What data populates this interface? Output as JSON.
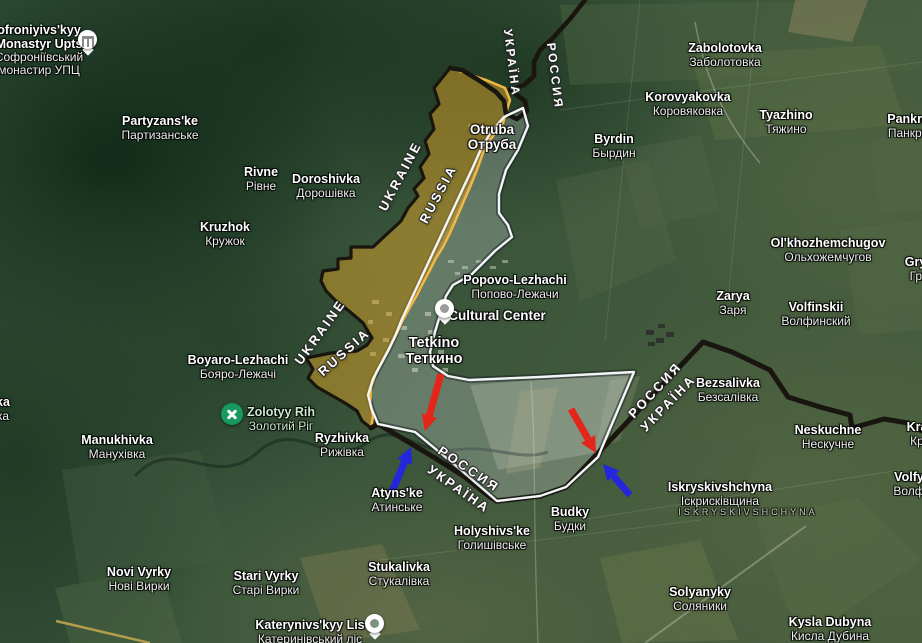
{
  "map_title": "Tetkino border area — annotated control map",
  "colors": {
    "zone_orange_fill": "rgba(222,163,40,0.5)",
    "zone_orange_stroke": "#f2b844",
    "zone_white_fill": "rgba(233,238,240,0.25)",
    "zone_white_stroke": "#f3f6f7",
    "state_border": "#19150f",
    "arrow_red": "#e3251a",
    "arrow_blue": "#2426dd",
    "park_label": "#cbe8cf"
  },
  "places": [
    {
      "lines": [
        "ofroniyivs'kyy",
        "Monastyr Upts",
        "Софроніївський",
        "монастир УПЦ"
      ],
      "x": 39,
      "y": 24,
      "nb": 2
    },
    {
      "lines": [
        "Partyzans'ke",
        "Партизанське"
      ],
      "x": 160,
      "y": 115
    },
    {
      "lines": [
        "Rivne",
        "Рівне"
      ],
      "x": 261,
      "y": 166
    },
    {
      "lines": [
        "Doroshivka",
        "Дорошівка"
      ],
      "x": 326,
      "y": 173
    },
    {
      "lines": [
        "Kruzhok",
        "Кружок"
      ],
      "x": 225,
      "y": 221
    },
    {
      "lines": [
        "Otruba",
        "Отруба"
      ],
      "x": 492,
      "y": 123,
      "nb": 2,
      "size": 13.5
    },
    {
      "lines": [
        "Zabolotovka",
        "Заболотовка"
      ],
      "x": 725,
      "y": 42
    },
    {
      "lines": [
        "Korovyakovka",
        "Коровяковка"
      ],
      "x": 688,
      "y": 91
    },
    {
      "lines": [
        "Tyazhino",
        "Тяжино"
      ],
      "x": 786,
      "y": 109
    },
    {
      "lines": [
        "Pankrato",
        "Панкрато"
      ],
      "x": 914,
      "y": 113
    },
    {
      "lines": [
        "Byrdin",
        "Бырдин"
      ],
      "x": 614,
      "y": 133
    },
    {
      "lines": [
        "Ol'khozhemchugov",
        "Ольхожемчугов"
      ],
      "x": 828,
      "y": 237
    },
    {
      "lines": [
        "Grya",
        "Гря"
      ],
      "x": 919,
      "y": 256
    },
    {
      "lines": [
        "Zarya",
        "Заря"
      ],
      "x": 733,
      "y": 290
    },
    {
      "lines": [
        "Volfinskii",
        "Волфинский"
      ],
      "x": 816,
      "y": 301
    },
    {
      "lines": [
        "Popovo-Lezhachi",
        "Попово-Лежачи"
      ],
      "x": 515,
      "y": 274
    },
    {
      "lines": [
        "Cultural Center"
      ],
      "x": 497,
      "y": 309,
      "size": 13.5
    },
    {
      "lines": [
        "Tetkino",
        "Теткино"
      ],
      "x": 434,
      "y": 336,
      "nb": 2,
      "size": 14.5
    },
    {
      "lines": [
        "Boyaro-Lezhachi",
        "Бояро-Лежачі"
      ],
      "x": 238,
      "y": 354
    },
    {
      "lines": [
        "Zolotyy Rih",
        "Золотий Ріг"
      ],
      "x": 281,
      "y": 406,
      "color": "#cbe8cf"
    },
    {
      "lines": [
        "Manukhivka",
        "Манухівка"
      ],
      "x": 117,
      "y": 434
    },
    {
      "lines": [
        "Ryzhivka",
        "Рижівка"
      ],
      "x": 342,
      "y": 432
    },
    {
      "lines": [
        "Atyns'ke",
        "Атинське"
      ],
      "x": 397,
      "y": 487
    },
    {
      "lines": [
        "Bezsalivka",
        "Безсалівка"
      ],
      "x": 728,
      "y": 377
    },
    {
      "lines": [
        "Neskuchne",
        "Нескучне"
      ],
      "x": 828,
      "y": 424
    },
    {
      "lines": [
        "Kra",
        "Кр"
      ],
      "x": 917,
      "y": 421
    },
    {
      "lines": [
        "Volfy",
        "Волф"
      ],
      "x": 909,
      "y": 471
    },
    {
      "lines": [
        "Iskryskivshchyna",
        "Іскрисківщина"
      ],
      "x": 720,
      "y": 481
    },
    {
      "lines": [
        "ISKRYSKIVSHCHYNA"
      ],
      "x": 748,
      "y": 508,
      "size": 9.5,
      "color": "rgba(228,231,226,0.85)",
      "spacing": 3,
      "nb": 0
    },
    {
      "lines": [
        "Budky",
        "Будки"
      ],
      "x": 570,
      "y": 506
    },
    {
      "lines": [
        "Holyshivs'ke",
        "Голишівське"
      ],
      "x": 492,
      "y": 525
    },
    {
      "lines": [
        "Stukalivka",
        "Стукалівка"
      ],
      "x": 399,
      "y": 561
    },
    {
      "lines": [
        "Novi Vyrky",
        "Нові Вирки"
      ],
      "x": 139,
      "y": 566
    },
    {
      "lines": [
        "Stari Vyrky",
        "Старі Вирки"
      ],
      "x": 266,
      "y": 570
    },
    {
      "lines": [
        "Katerynivs'kyy Lis",
        "Катеринівський ліс"
      ],
      "x": 310,
      "y": 619
    },
    {
      "lines": [
        "Solyanyky",
        "Соляники"
      ],
      "x": 700,
      "y": 586
    },
    {
      "lines": [
        "Kysla Dubyna",
        "Кисла Дубина"
      ],
      "x": 830,
      "y": 616
    },
    {
      "lines": [
        "ka",
        "ка"
      ],
      "x": 3,
      "y": 396
    }
  ],
  "border_labels": [
    {
      "text": "UKRAINE",
      "x": 400,
      "y": 176,
      "rotate": -62
    },
    {
      "text": "RUSSIA",
      "x": 438,
      "y": 194,
      "rotate": -62
    },
    {
      "text": "UKRAINE",
      "x": 320,
      "y": 332,
      "rotate": -54
    },
    {
      "text": "RUSSIA",
      "x": 344,
      "y": 352,
      "rotate": -42
    },
    {
      "text": "УКРАЇНА",
      "x": 512,
      "y": 63,
      "rotate": 83,
      "size": 12
    },
    {
      "text": "РОССИЯ",
      "x": 555,
      "y": 76,
      "rotate": 83,
      "size": 12
    },
    {
      "text": "РОССИЯ",
      "x": 469,
      "y": 469,
      "rotate": 34
    },
    {
      "text": "УКРАЇНА",
      "x": 459,
      "y": 489,
      "rotate": 35
    },
    {
      "text": "РОССИЯ",
      "x": 655,
      "y": 390,
      "rotate": -47
    },
    {
      "text": "УКРАЇНА",
      "x": 668,
      "y": 403,
      "rotate": -46
    }
  ],
  "pois": [
    {
      "icon": "monastery-icon",
      "style": "white mon-pin",
      "x": 88,
      "y": 42
    },
    {
      "icon": "cultural-center-icon",
      "style": "white",
      "x": 445,
      "y": 311
    },
    {
      "icon": "attraction-icon",
      "style": "green",
      "x": 232,
      "y": 414
    },
    {
      "icon": "park-icon",
      "style": "white park",
      "x": 375,
      "y": 626
    }
  ],
  "arrows": [
    {
      "name": "red-attack-arrow-west",
      "color": "#e3251a",
      "x1": 441,
      "y1": 374,
      "x2": 425,
      "y2": 431
    },
    {
      "name": "red-attack-arrow-east",
      "color": "#e3251a",
      "x1": 571,
      "y1": 409,
      "x2": 596,
      "y2": 453
    },
    {
      "name": "blue-counter-arrow-west",
      "color": "#2426dd",
      "x1": 391,
      "y1": 494,
      "x2": 411,
      "y2": 447
    },
    {
      "name": "blue-counter-arrow-east",
      "color": "#2426dd",
      "x1": 630,
      "y1": 495,
      "x2": 603,
      "y2": 464
    }
  ],
  "overlays": {
    "orange_zone": {
      "fill": "rgba(222,163,40,0.5)",
      "stroke": "#f2b844",
      "stroke_width": 2.5,
      "points": [
        [
          450,
          68
        ],
        [
          468,
          74
        ],
        [
          486,
          80
        ],
        [
          505,
          88
        ],
        [
          510,
          100
        ],
        [
          503,
          123
        ],
        [
          490,
          140
        ],
        [
          483,
          153
        ],
        [
          477,
          170
        ],
        [
          470,
          187
        ],
        [
          463,
          203
        ],
        [
          457,
          217
        ],
        [
          450,
          233
        ],
        [
          443,
          247
        ],
        [
          436,
          258
        ],
        [
          430,
          270
        ],
        [
          423,
          283
        ],
        [
          417,
          295
        ],
        [
          410,
          307
        ],
        [
          403,
          320
        ],
        [
          397,
          333
        ],
        [
          390,
          347
        ],
        [
          383,
          360
        ],
        [
          376,
          373
        ],
        [
          371,
          387
        ],
        [
          370,
          403
        ],
        [
          373,
          416
        ],
        [
          371,
          428
        ],
        [
          362,
          421
        ],
        [
          357,
          411
        ],
        [
          345,
          403
        ],
        [
          331,
          395
        ],
        [
          317,
          387
        ],
        [
          308,
          378
        ],
        [
          313,
          369
        ],
        [
          306,
          358
        ],
        [
          331,
          353
        ],
        [
          357,
          351
        ],
        [
          367,
          345
        ],
        [
          372,
          338
        ],
        [
          363,
          323
        ],
        [
          349,
          311
        ],
        [
          336,
          301
        ],
        [
          326,
          291
        ],
        [
          321,
          281
        ],
        [
          323,
          271
        ],
        [
          338,
          269
        ],
        [
          338,
          259
        ],
        [
          351,
          258
        ],
        [
          351,
          247
        ],
        [
          373,
          247
        ],
        [
          401,
          221
        ],
        [
          408,
          208
        ],
        [
          418,
          196
        ],
        [
          414,
          189
        ],
        [
          424,
          178
        ],
        [
          420,
          167
        ],
        [
          429,
          154
        ],
        [
          425,
          141
        ],
        [
          434,
          129
        ],
        [
          430,
          114
        ],
        [
          439,
          104
        ],
        [
          434,
          88
        ]
      ]
    },
    "white_zone": {
      "fill": "rgba(233,238,240,0.25)",
      "stroke": "#f3f6f7",
      "stroke_width": 2.4,
      "shadow": "rgba(25,30,35,0.5)",
      "points": [
        [
          523,
          108
        ],
        [
          528,
          126
        ],
        [
          518,
          150
        ],
        [
          506,
          170
        ],
        [
          499,
          194
        ],
        [
          499,
          213
        ],
        [
          508,
          225
        ],
        [
          512,
          237
        ],
        [
          495,
          251
        ],
        [
          471,
          275
        ],
        [
          453,
          285
        ],
        [
          446,
          296
        ],
        [
          441,
          312
        ],
        [
          435,
          332
        ],
        [
          430,
          352
        ],
        [
          433,
          366
        ],
        [
          448,
          376
        ],
        [
          469,
          380
        ],
        [
          540,
          377
        ],
        [
          634,
          372
        ],
        [
          598,
          457
        ],
        [
          566,
          487
        ],
        [
          540,
          496
        ],
        [
          497,
          501
        ],
        [
          455,
          465
        ],
        [
          415,
          432
        ],
        [
          378,
          424
        ],
        [
          372,
          410
        ],
        [
          368,
          395
        ],
        [
          373,
          379
        ],
        [
          381,
          364
        ],
        [
          389,
          349
        ],
        [
          396,
          334
        ],
        [
          402,
          319
        ],
        [
          409,
          304
        ],
        [
          416,
          289
        ],
        [
          423,
          274
        ],
        [
          430,
          259
        ],
        [
          437,
          244
        ],
        [
          444,
          229
        ],
        [
          451,
          214
        ],
        [
          458,
          199
        ],
        [
          465,
          184
        ],
        [
          473,
          167
        ],
        [
          481,
          149
        ],
        [
          491,
          132
        ],
        [
          504,
          117
        ]
      ]
    },
    "border_paths": [
      {
        "width": 4.6,
        "points": [
          [
            585,
            0
          ],
          [
            570,
            19
          ],
          [
            552,
            39
          ],
          [
            540,
            50
          ],
          [
            534,
            62
          ],
          [
            534,
            76
          ],
          [
            524,
            85
          ],
          [
            510,
            90
          ],
          [
            517,
            95
          ],
          [
            525,
            101
          ],
          [
            527,
            111
          ],
          [
            517,
            119
          ],
          [
            506,
            114
          ],
          [
            504,
            101
          ],
          [
            496,
            92
          ],
          [
            480,
            81
          ],
          [
            462,
            70
          ],
          [
            450,
            68
          ]
        ]
      },
      {
        "width": 3.2,
        "points": [
          [
            450,
            68
          ],
          [
            434,
            88
          ],
          [
            439,
            104
          ],
          [
            430,
            114
          ],
          [
            434,
            129
          ],
          [
            425,
            141
          ],
          [
            429,
            154
          ],
          [
            420,
            167
          ],
          [
            424,
            178
          ],
          [
            414,
            189
          ],
          [
            418,
            196
          ],
          [
            408,
            208
          ],
          [
            401,
            221
          ],
          [
            373,
            247
          ],
          [
            351,
            247
          ],
          [
            351,
            258
          ],
          [
            338,
            259
          ],
          [
            338,
            269
          ],
          [
            323,
            271
          ],
          [
            321,
            281
          ],
          [
            326,
            291
          ],
          [
            336,
            301
          ],
          [
            349,
            311
          ],
          [
            363,
            323
          ],
          [
            372,
            338
          ],
          [
            367,
            345
          ],
          [
            357,
            351
          ],
          [
            331,
            353
          ],
          [
            306,
            358
          ],
          [
            313,
            369
          ],
          [
            308,
            378
          ],
          [
            317,
            387
          ],
          [
            331,
            395
          ],
          [
            345,
            403
          ],
          [
            357,
            411
          ],
          [
            362,
            421
          ],
          [
            371,
            428
          ]
        ]
      },
      {
        "width": 5,
        "points": [
          [
            371,
            428
          ],
          [
            378,
            424
          ],
          [
            405,
            440
          ],
          [
            435,
            458
          ],
          [
            465,
            477
          ],
          [
            490,
            497
          ],
          [
            497,
            501
          ],
          [
            540,
            496
          ],
          [
            566,
            487
          ],
          [
            703,
            342
          ],
          [
            732,
            352
          ],
          [
            770,
            370
          ],
          [
            788,
            397
          ],
          [
            820,
            407
          ],
          [
            850,
            415
          ],
          [
            852,
            428
          ],
          [
            884,
            419
          ],
          [
            908,
            423
          ],
          [
            922,
            431
          ]
        ]
      }
    ]
  }
}
